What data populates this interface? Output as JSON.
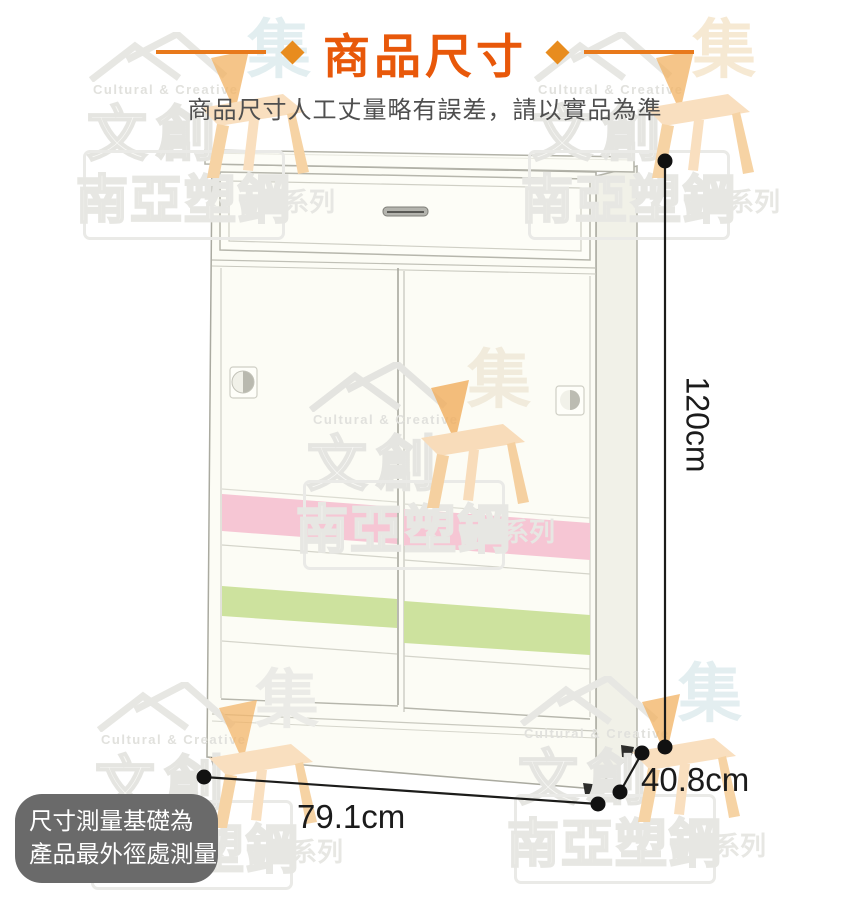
{
  "header": {
    "title": "商品尺寸",
    "subtitle": "商品尺寸人工丈量略有誤差，請以實品為準"
  },
  "dimensions": {
    "height": "120cm",
    "width": "79.1cm",
    "depth": "40.8cm"
  },
  "note": {
    "line1": "尺寸測量基礎為",
    "line2": "產品最外徑處測量"
  },
  "watermark": {
    "cultural": "Cultural & Creative",
    "wenchuang": "文創",
    "brand": "南亞塑鋼",
    "series": "系列",
    "ji": "集"
  },
  "colors": {
    "accent_orange": "#e8580a",
    "stripe_pink": "#f6c6d4",
    "stripe_green": "#cde29e"
  }
}
